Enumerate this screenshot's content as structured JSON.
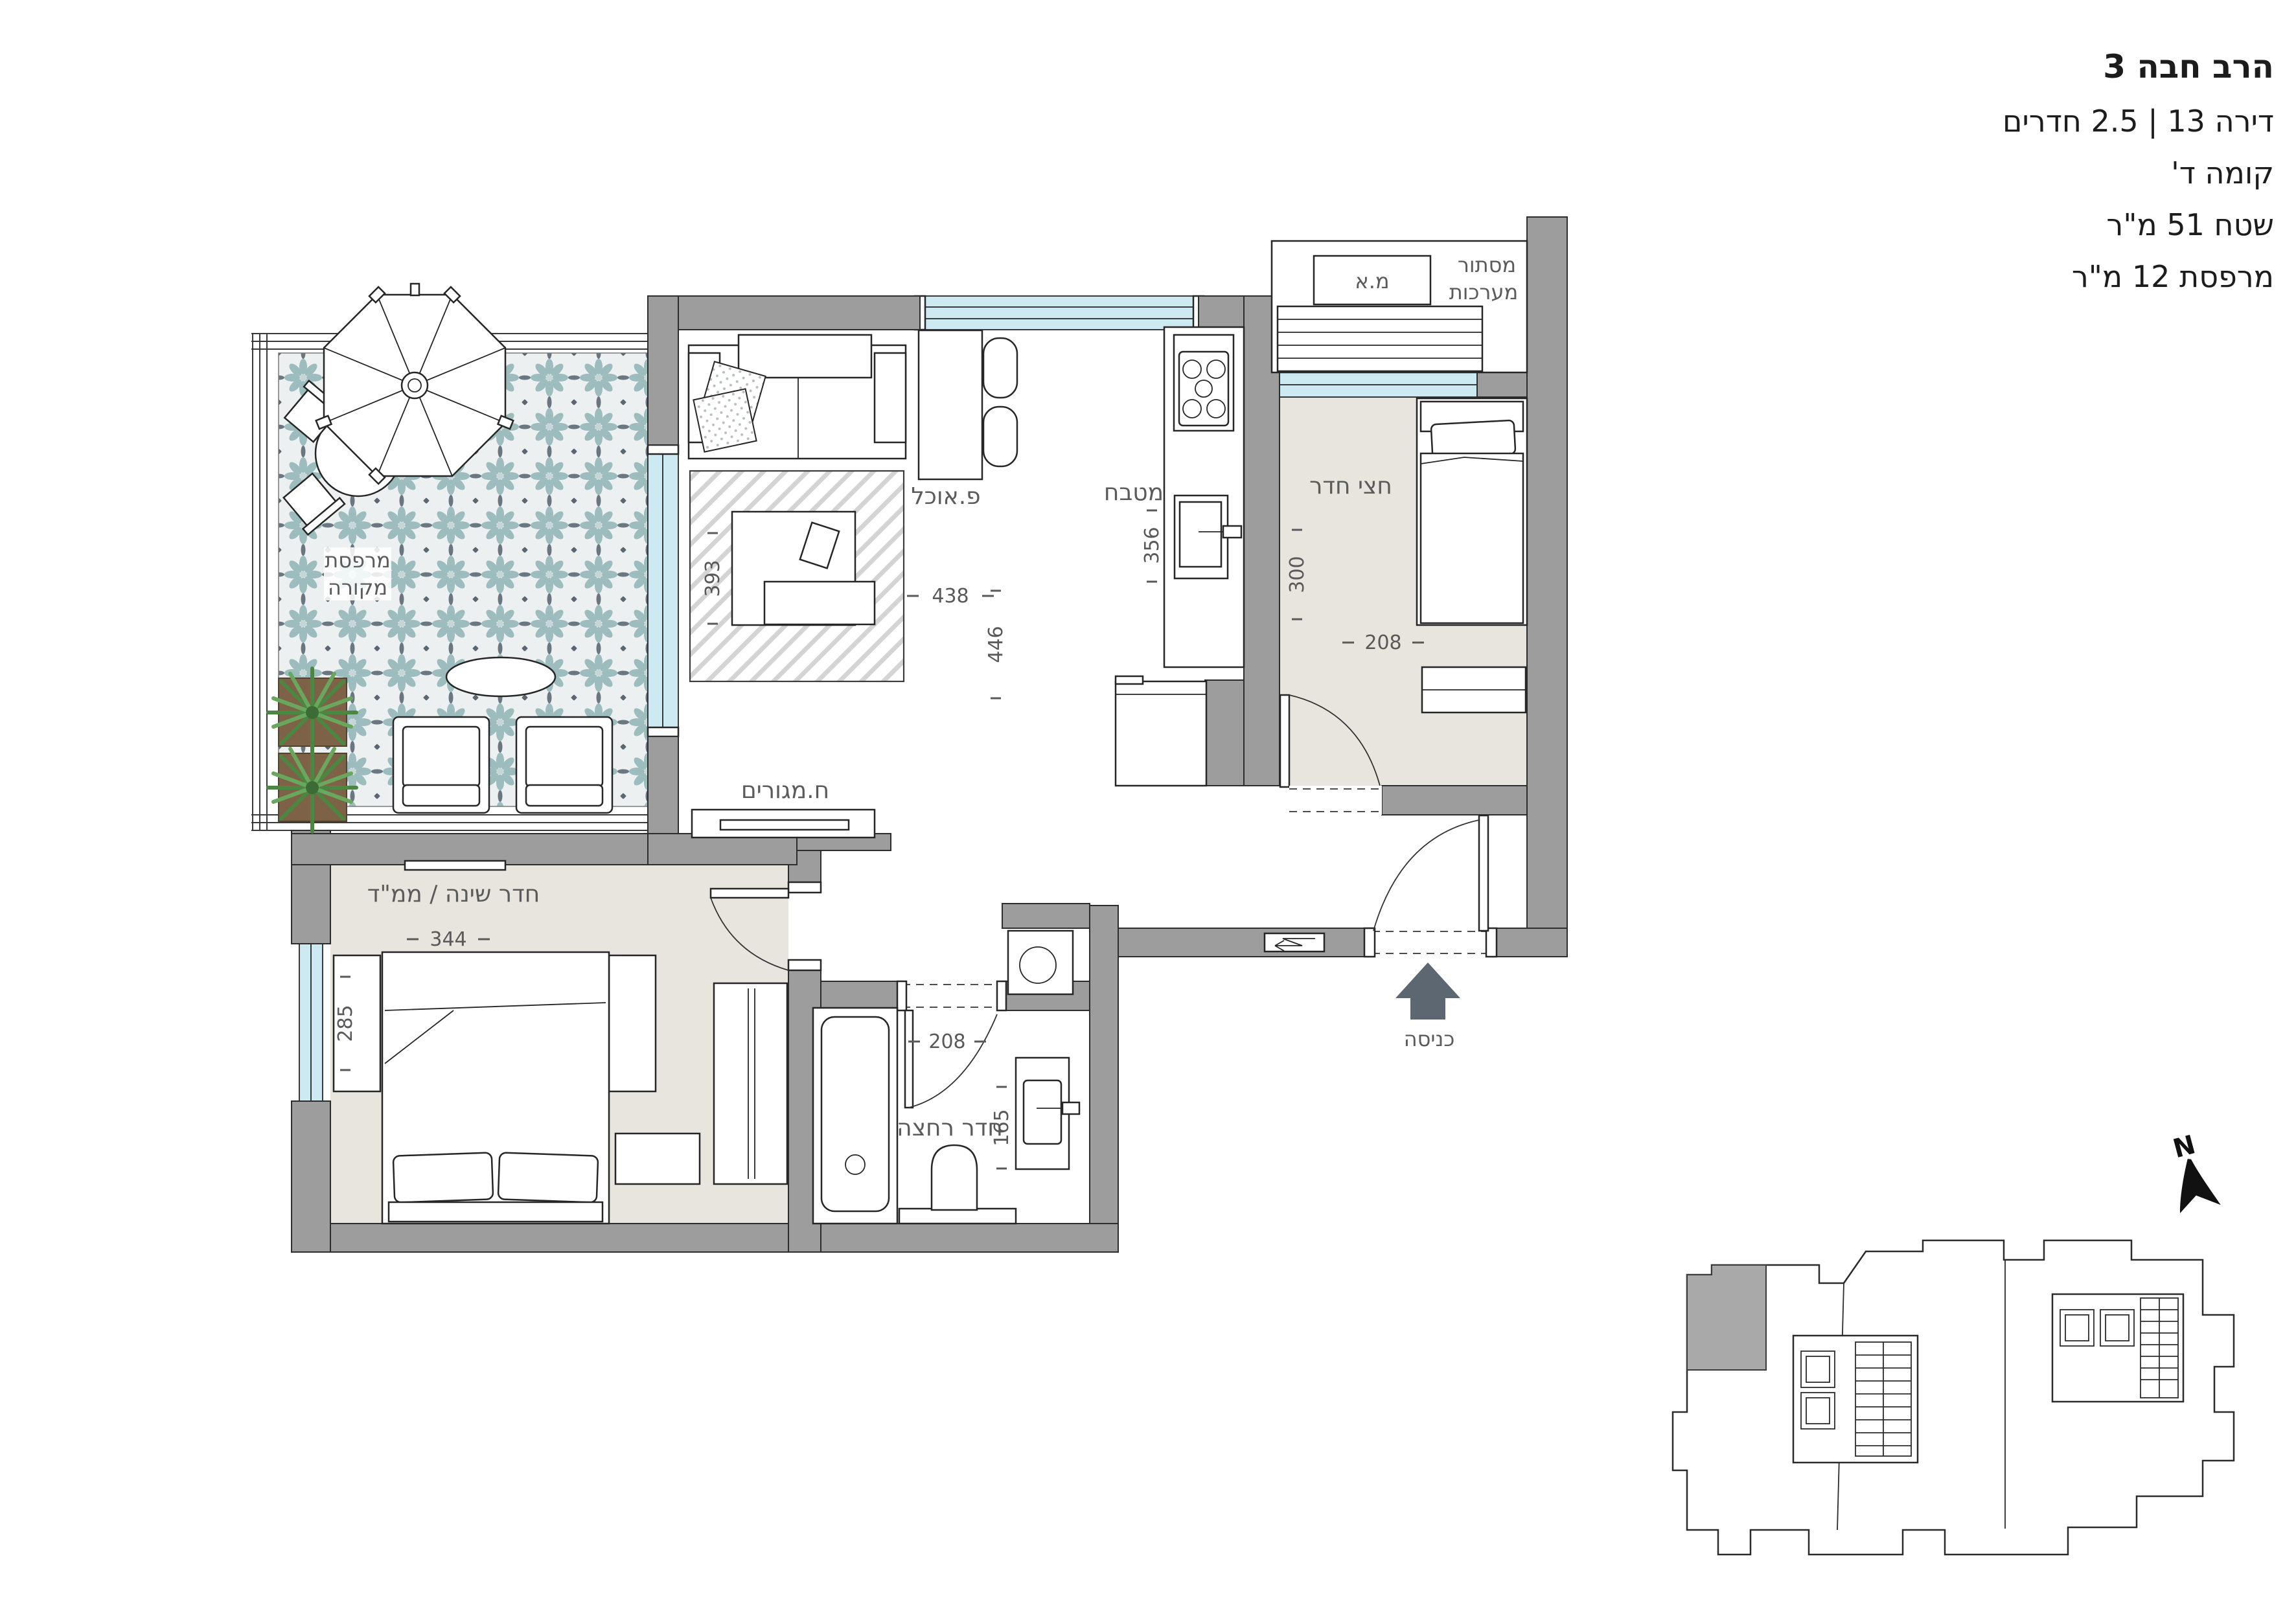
{
  "title_block": {
    "line1": "הרב חבה 3",
    "line2": "דירה 13 | 2.5 חדרים",
    "line3": "קומה ד'",
    "line4": "שטח 51 מ\"ר",
    "line5": "מרפסת 12 מ\"ר"
  },
  "plan": {
    "rooms": {
      "balcony_line1": "מרפסת",
      "balcony_line2": "מקורה",
      "living": "ח.מגורים",
      "dining": "פ.אוכל",
      "kitchen": "מטבח",
      "half_room": "חצי חדר",
      "bedroom": "חדר שינה / ממ\"ד",
      "bathroom": "חדר רחצה",
      "entrance": "כניסה",
      "systems_line1": "מסתור",
      "systems_line2": "מערכות",
      "ac_unit": "מ.א"
    },
    "dims": {
      "living_width": "438",
      "living_height": "446",
      "rug": "393",
      "kitchen": "356",
      "half_room_height": "300",
      "half_room_width": "208",
      "bedroom_width": "344",
      "bedroom_height": "285",
      "bathroom_width": "208",
      "bathroom_height": "165"
    },
    "north": "N"
  },
  "colors": {
    "wall": "#9d9d9d",
    "floor_beige": "#e8e5df",
    "glass_blue": "#cdeaf2",
    "tile_teal": "#9cbcbd",
    "accent_dark": "#5a6772"
  }
}
